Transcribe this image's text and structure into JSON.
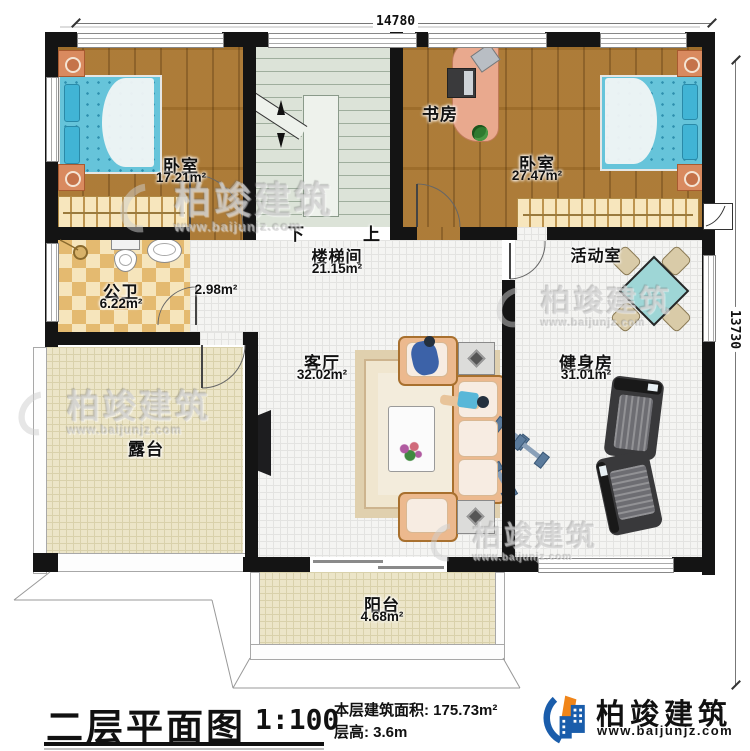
{
  "title_block": {
    "title": "二层平面图",
    "scale": "1:100",
    "area_label": "本层建筑面积:",
    "area_value": "175.73m²",
    "height_label": "层高:",
    "height_value": "3.6m"
  },
  "brand": {
    "name": "柏竣建筑",
    "url": "www.baijunjz.com"
  },
  "watermark": {
    "name": "柏竣建筑",
    "url": "www.baijunjz.com"
  },
  "dimensions": {
    "width": "14780",
    "height": "13730"
  },
  "stairs": {
    "down": "下",
    "up": "上"
  },
  "rooms": {
    "bedroom1": {
      "name": "卧室",
      "area": "17.21m²"
    },
    "study": {
      "name": "书房"
    },
    "bedroom2": {
      "name": "卧室",
      "area": "27.47m²"
    },
    "stairwell": {
      "name": "楼梯间",
      "area": "21.15m²"
    },
    "bathroom": {
      "name": "公卫",
      "area": "6.22m²"
    },
    "hall": {
      "area": "2.98m²"
    },
    "living": {
      "name": "客厅",
      "area": "32.02m²"
    },
    "activity": {
      "name": "活动室"
    },
    "gym": {
      "name": "健身房",
      "area": "31.01m²"
    },
    "terrace": {
      "name": "露台"
    },
    "balcony": {
      "name": "阳台",
      "area": "4.68m²"
    }
  },
  "colors": {
    "wall": "#141414",
    "wood_floor": "#a9752e",
    "tile_floor": "#e4ba70",
    "terrace_floor": "#ece5c8",
    "mattress": "#66c4da",
    "sofa": "#ecb98e",
    "brand_blue": "#1a5dab",
    "brand_orange": "#f08519"
  }
}
